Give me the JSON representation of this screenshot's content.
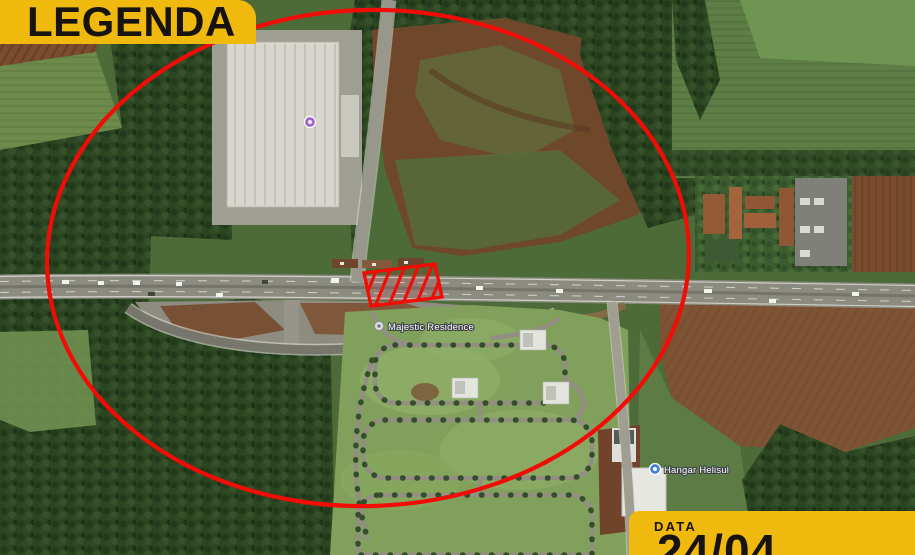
{
  "map": {
    "labels": [
      {
        "name": "majestic-residence",
        "text": "Majestic Residence"
      },
      {
        "name": "hangar-helisul",
        "text": "Hangar Helisul"
      }
    ]
  },
  "annotations": {
    "circle_color": "#f20c07",
    "plot_marker_color": "#f20c07",
    "banner_color": "#f0b90d",
    "banner_text_color": "#161310"
  },
  "legend_banner": {
    "label": "LEGENDA"
  },
  "date_banner": {
    "label": "DATA",
    "value": "24/04"
  }
}
